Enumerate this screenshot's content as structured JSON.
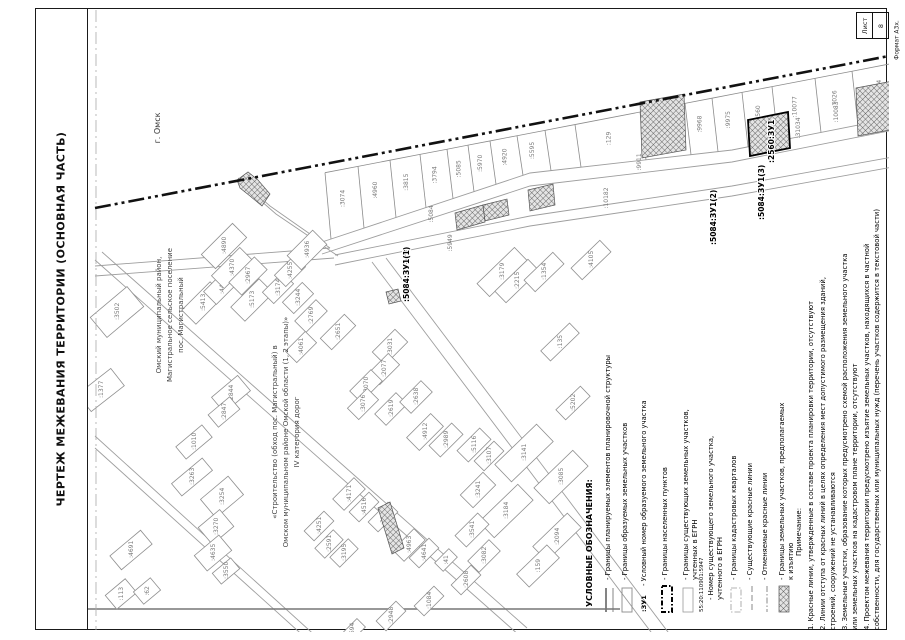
{
  "page": {
    "title": "ЧЕРТЕЖ МЕЖЕВАНИЯ ТЕРРИТОРИИ (ОСНОВНАЯ ЧАСТЬ)",
    "sheet_label": "Лист",
    "sheet_number": "8",
    "format_label": "Формат А3х."
  },
  "map": {
    "city_label": {
      "text": "г. Омск",
      "x": 160,
      "y": 128
    },
    "settlement_label": {
      "x0": 161,
      "y": 315,
      "lines": [
        "Омский муниципальный район,",
        "Магистральное сельское поселение",
        "пос. Магистральный"
      ]
    },
    "road_label": {
      "x0": 277,
      "y": 432,
      "lines": [
        "«Строительство (обход пос. Магистральный) в",
        "Омском муниципальном районе Омской области (1, 2 этапы)»",
        "IV категория дорог"
      ]
    },
    "boundary": {
      "x1": 95,
      "y1": 208,
      "x2": 889,
      "y2": 56
    },
    "quarter_line": {
      "x": 96,
      "y1": 10,
      "y2": 630
    },
    "bottom_line": {
      "x1": 36,
      "y1": 609,
      "x2": 620,
      "y2": 609
    },
    "streets": [
      [
        [
          322,
          242
        ],
        [
          530,
          173
        ],
        [
          732,
          150
        ],
        [
          904,
          116
        ]
      ],
      [
        [
          322,
          254
        ],
        [
          530,
          186
        ],
        [
          732,
          162
        ],
        [
          904,
          128
        ]
      ],
      [
        [
          335,
          255
        ],
        [
          530,
          216
        ],
        [
          732,
          186
        ],
        [
          904,
          155
        ]
      ],
      [
        [
          335,
          265
        ],
        [
          530,
          226
        ],
        [
          732,
          196
        ],
        [
          904,
          165
        ]
      ],
      [
        [
          330,
          248
        ],
        [
          270,
          206
        ],
        [
          238,
          178
        ]
      ],
      [
        [
          338,
          256
        ],
        [
          276,
          214
        ],
        [
          244,
          186
        ]
      ],
      [
        [
          95,
          266
        ],
        [
          330,
          248
        ]
      ],
      [
        [
          95,
          276
        ],
        [
          334,
          258
        ]
      ],
      [
        [
          95,
          260
        ],
        [
          520,
          636
        ]
      ],
      [
        [
          102,
          252
        ],
        [
          527,
          628
        ]
      ],
      [
        [
          372,
          262
        ],
        [
          657,
          640
        ]
      ],
      [
        [
          386,
          258
        ],
        [
          671,
          636
        ]
      ],
      [
        [
          95,
          448
        ],
        [
          308,
          640
        ]
      ],
      [
        [
          95,
          436
        ],
        [
          320,
          640
        ]
      ]
    ],
    "band": {
      "top": {
        "x1": 95,
        "y1": 213,
        "x2": 905,
        "y2": 57
      },
      "xs": [
        325,
        358,
        390,
        420,
        447,
        468,
        490,
        517,
        545,
        575,
        640,
        685,
        712,
        742,
        772,
        815,
        852,
        904
      ],
      "labels": [
        ":3074",
        ":4960",
        ":3815",
        ":3794",
        ":5085",
        ":5970",
        ":4920",
        ":5595",
        "",
        ":129",
        ":5956",
        ":9968",
        ":9975",
        ":2560",
        ":10077",
        ":7026",
        ":10484"
      ]
    },
    "extra_labels": [
      {
        "t": ":31034",
        "x": 800,
        "y": 128
      },
      {
        "t": ":10083",
        "x": 838,
        "y": 112
      }
    ],
    "strip_labels": [
      {
        "t": ":5084",
        "x": 433,
        "y": 214
      },
      {
        "t": ":5949",
        "x": 452,
        "y": 243
      },
      {
        "t": ":9911",
        "x": 641,
        "y": 162
      },
      {
        "t": ":10182",
        "x": 608,
        "y": 198
      }
    ],
    "hatches": [
      [
        [
          237,
          180
        ],
        [
          248,
          172
        ],
        [
          258,
          180
        ],
        [
          270,
          194
        ],
        [
          262,
          206
        ],
        [
          250,
          196
        ],
        [
          240,
          188
        ]
      ],
      [
        [
          455,
          213
        ],
        [
          483,
          205
        ],
        [
          485,
          222
        ],
        [
          457,
          230
        ]
      ],
      [
        [
          483,
          205
        ],
        [
          507,
          199
        ],
        [
          509,
          215
        ],
        [
          485,
          221
        ]
      ],
      [
        [
          640,
          102
        ],
        [
          684,
          94
        ],
        [
          686,
          150
        ],
        [
          642,
          158
        ]
      ],
      [
        [
          748,
          120
        ],
        [
          788,
          112
        ],
        [
          790,
          148
        ],
        [
          750,
          156
        ]
      ],
      [
        [
          856,
          88
        ],
        [
          898,
          80
        ],
        [
          900,
          128
        ],
        [
          858,
          136
        ]
      ],
      [
        [
          528,
          190
        ],
        [
          553,
          184
        ],
        [
          555,
          205
        ],
        [
          530,
          211
        ]
      ],
      [
        [
          378,
          508
        ],
        [
          390,
          502
        ],
        [
          404,
          548
        ],
        [
          392,
          554
        ]
      ],
      [
        [
          386,
          292
        ],
        [
          398,
          289
        ],
        [
          401,
          301
        ],
        [
          389,
          304
        ]
      ]
    ],
    "formed_outline": [
      [
        748,
        120
      ],
      [
        788,
        112
      ],
      [
        790,
        148
      ],
      [
        750,
        156
      ]
    ],
    "bold_labels": [
      {
        "t": ":5084:ЗУ1(1)",
        "x": 409,
        "y": 302
      },
      {
        "t": ":5084:ЗУ1(2)",
        "x": 716,
        "y": 245
      },
      {
        "t": ":5084:ЗУ1(3)",
        "x": 764,
        "y": 220
      },
      {
        "t": ":2560:ЗУ1",
        "x": 774,
        "y": 163
      }
    ],
    "leader": {
      "x1": 407,
      "y1": 264,
      "x2": 404,
      "y2": 248
    },
    "parcels": [
      [
        ":3502",
        117,
        312,
        48,
        26,
        -40
      ],
      [
        ":1377",
        101,
        390,
        42,
        22,
        -38
      ],
      [
        ":5413",
        203,
        303,
        40,
        20,
        -45
      ],
      [
        ":4426",
        222,
        286,
        34,
        18,
        -45
      ],
      [
        ":4890",
        224,
        246,
        44,
        20,
        -45
      ],
      [
        ":4370",
        232,
        268,
        40,
        18,
        -45
      ],
      [
        ":2967",
        248,
        276,
        36,
        18,
        -45
      ],
      [
        ":5173",
        252,
        300,
        40,
        20,
        -45
      ],
      [
        ":3174",
        278,
        288,
        28,
        16,
        -45
      ],
      [
        ":4255",
        290,
        271,
        28,
        16,
        -45
      ],
      [
        ":4936",
        307,
        250,
        36,
        20,
        -45
      ],
      [
        ":3244",
        298,
        298,
        28,
        16,
        -45
      ],
      [
        ":2769",
        311,
        316,
        30,
        16,
        -45
      ],
      [
        ":2651",
        338,
        332,
        34,
        16,
        -45
      ],
      [
        ":4061",
        301,
        347,
        28,
        16,
        -45
      ],
      [
        ":3031",
        390,
        347,
        32,
        18,
        -45
      ],
      [
        ":2077",
        384,
        369,
        28,
        16,
        -45
      ],
      [
        ":3070",
        366,
        386,
        30,
        16,
        -45
      ],
      [
        ":3076",
        363,
        404,
        28,
        16,
        -45
      ],
      [
        ":2619",
        391,
        409,
        30,
        16,
        -45
      ],
      [
        ":2638",
        416,
        397,
        30,
        16,
        -45
      ],
      [
        ":4912",
        425,
        432,
        34,
        18,
        -45
      ],
      [
        ":2989",
        446,
        440,
        32,
        16,
        -45
      ],
      [
        ":5116",
        474,
        445,
        32,
        16,
        -45
      ],
      [
        ":3107",
        489,
        456,
        28,
        14,
        -45
      ],
      [
        ":3241",
        478,
        490,
        32,
        18,
        -45
      ],
      [
        ":4171",
        349,
        494,
        30,
        16,
        -45
      ],
      [
        ":4516",
        364,
        507,
        28,
        14,
        -45
      ],
      [
        ":3194",
        383,
        517,
        28,
        14,
        -45
      ],
      [
        ":4251",
        319,
        526,
        28,
        14,
        -45
      ],
      [
        ":2591",
        329,
        544,
        26,
        14,
        -45
      ],
      [
        ":3195",
        344,
        553,
        26,
        14,
        -45
      ],
      [
        ":4963",
        409,
        545,
        30,
        16,
        -45
      ],
      [
        ":4641",
        424,
        553,
        28,
        14,
        -45
      ],
      [
        ":41",
        446,
        560,
        20,
        12,
        -45
      ],
      [
        ":3179",
        502,
        272,
        52,
        18,
        -44
      ],
      [
        ":2215",
        517,
        281,
        46,
        16,
        -44
      ],
      [
        ":1354",
        544,
        272,
        40,
        16,
        -44
      ],
      [
        ":4105",
        591,
        260,
        40,
        16,
        -44
      ],
      [
        ":135",
        560,
        342,
        40,
        14,
        -44
      ],
      [
        ":5202",
        573,
        403,
        34,
        14,
        -44
      ],
      [
        ":3263",
        192,
        477,
        40,
        16,
        -40
      ],
      [
        ":3254",
        222,
        497,
        36,
        24,
        -40
      ],
      [
        ":3270",
        216,
        527,
        28,
        22,
        -40
      ],
      [
        ":4635",
        213,
        553,
        32,
        20,
        -40
      ],
      [
        ":3550",
        226,
        571,
        24,
        14,
        -40
      ],
      [
        ":4691",
        131,
        550,
        40,
        18,
        -40
      ],
      [
        ":113",
        121,
        594,
        26,
        18,
        -40
      ],
      [
        ":62",
        147,
        591,
        22,
        16,
        -40
      ],
      [
        ":2844",
        231,
        394,
        34,
        20,
        -40
      ],
      [
        ":2847",
        224,
        412,
        28,
        16,
        -40
      ],
      [
        ":1010",
        194,
        442,
        34,
        16,
        -40
      ],
      [
        ":3141",
        524,
        453,
        58,
        24,
        -44
      ],
      [
        ":3085",
        561,
        477,
        54,
        22,
        -44
      ],
      [
        ":3184",
        506,
        511,
        54,
        22,
        -44
      ],
      [
        ":2094",
        557,
        537,
        48,
        20,
        -44
      ],
      [
        ":159",
        538,
        566,
        42,
        18,
        -44
      ],
      [
        ":3541",
        472,
        530,
        32,
        16,
        -45
      ],
      [
        ":3082",
        484,
        556,
        30,
        16,
        -45
      ],
      [
        ":2608",
        466,
        580,
        28,
        14,
        -45
      ],
      [
        ":1084",
        429,
        601,
        28,
        14,
        -45
      ],
      [
        ":2948",
        391,
        616,
        28,
        14,
        -45
      ],
      [
        ":1694",
        352,
        632,
        26,
        12,
        -45
      ]
    ],
    "compass": {
      "x": 66,
      "y": 572,
      "n": "С",
      "s": "Ю",
      "w": "З",
      "e": "В"
    }
  },
  "legend": {
    "title": "УСЛОВНЫЕ ОБОЗНАЧЕНИЯ:",
    "title_x": 592,
    "title_y": 607,
    "items": [
      {
        "x": 610,
        "sym": "planning",
        "lines": [
          "- Границы планируемых элементов планировочной структуры"
        ]
      },
      {
        "x": 627,
        "sym": "formed",
        "lines": [
          "- Границы образуемых земельных участков"
        ]
      },
      {
        "x": 646,
        "sym": "zu",
        "sym_text": ":ЗУ1",
        "lines": [
          "- Условный номер образуемого земельного участка"
        ]
      },
      {
        "x": 667,
        "sym": "settlement",
        "lines": [
          "- Границы населенных пунктов"
        ]
      },
      {
        "x": 688,
        "sym": "existing",
        "lines": [
          "- Границы существующих земельных участков,",
          "учтенных в ЕГРН"
        ]
      },
      {
        "x": 712,
        "sym": "number",
        "sym_text": "55:20:110901:5947",
        "lines": [
          "- Номер существующего земельного участка,",
          "учтенного в ЕГРН"
        ]
      },
      {
        "x": 736,
        "sym": "quarter",
        "lines": [
          "- Границы кадастровых кварталов"
        ]
      },
      {
        "x": 752,
        "sym": "redline",
        "lines": [
          "- Существующие красные линии"
        ]
      },
      {
        "x": 767,
        "sym": "cancelled",
        "lines": [
          "- Отменяемые красные линии"
        ]
      },
      {
        "x": 784,
        "sym": "seizure",
        "lines": [
          "- Границы земельных участков, предполагаемых",
          "к изъятию"
        ]
      }
    ]
  },
  "notes": {
    "title": "Примечание:",
    "title_x": 801,
    "title_y": 556,
    "base_y": 630,
    "lines": [
      {
        "x": 813,
        "text": "1. Красные линии, утвержденные в составе проекта планировки территории, отсутствуют"
      },
      {
        "x": 825,
        "text": "2. Линии отступа от красных линий в целях определения мест допустимого размещения зданий,"
      },
      {
        "x": 835,
        "text": "строений, сооружений не устанавливаются"
      },
      {
        "x": 847,
        "text": "3. Земельные участки, образование которых предусмотрено схемой расположения земельного участка"
      },
      {
        "x": 857,
        "text": "или земельных участков на кадастровом плане территории, отсутствуют"
      },
      {
        "x": 869,
        "text": "4. Проектом межевания территории предусмотрено изъятие земельных участков, находящихся в частной"
      },
      {
        "x": 879,
        "text": "собственности, для государственных или муниципальных нужд (перечень участков содержится в текстовой части)"
      }
    ]
  }
}
